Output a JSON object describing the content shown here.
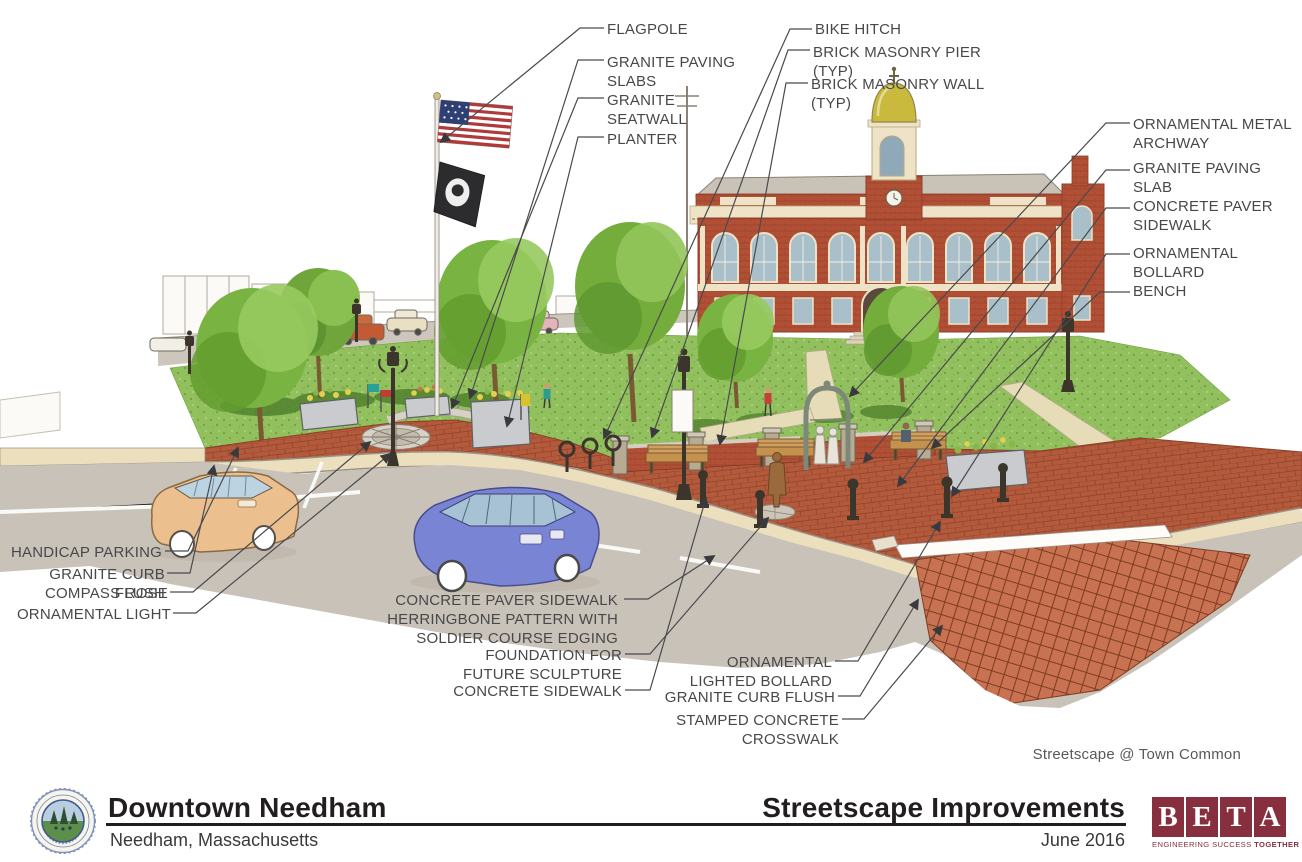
{
  "callouts": {
    "flagpole": "FLAGPOLE",
    "granite_paving_slabs": "GRANITE PAVING\nSLABS",
    "granite_seatwall": "GRANITE\nSEATWALL",
    "planter": "PLANTER",
    "bike_hitch": "BIKE HITCH",
    "brick_masonry_pier": "BRICK MASONRY PIER\n(TYP)",
    "brick_masonry_wall": "BRICK MASONRY WALL\n(TYP)",
    "ornamental_metal_archway": "ORNAMENTAL METAL\nARCHWAY",
    "granite_paving_slab": "GRANITE PAVING SLAB",
    "concrete_paver_sidewalk": "CONCRETE PAVER\nSIDEWALK",
    "ornamental_bollard": "ORNAMENTAL\nBOLLARD",
    "bench": "BENCH",
    "handicap_parking": "HANDICAP PARKING",
    "granite_curb_flush_left": "GRANITE CURB FLUSH",
    "compass_rose": "COMPASS ROSE",
    "ornamental_light": "ORNAMENTAL LIGHT",
    "herringbone_sidewalk": "CONCRETE PAVER SIDEWALK\nHERRINGBONE PATTERN WITH\nSOLDIER COURSE EDGING",
    "foundation_sculpture": "FOUNDATION FOR\nFUTURE SCULPTURE",
    "concrete_sidewalk": "CONCRETE SIDEWALK",
    "ornamental_lighted_bollard": "ORNAMENTAL\nLIGHTED BOLLARD",
    "granite_curb_flush_right": "GRANITE CURB FLUSH",
    "stamped_concrete_crosswalk": "STAMPED CONCRETE\nCROSSWALK"
  },
  "caption": "Streetscape @ Town Common",
  "footer": {
    "project_title": "Downtown Needham",
    "project_subtitle": "Needham, Massachusetts",
    "sheet_title": "Streetscape Improvements",
    "date": "June 2016",
    "beta": {
      "letters": [
        "B",
        "E",
        "T",
        "A"
      ],
      "tagline_regular": "ENGINEERING SUCCESS",
      "tagline_bold": "TOGETHER",
      "brand_color": "#872f3f"
    }
  },
  "colors": {
    "label_text": "#48484b",
    "plaza_brick": "#b45a3c",
    "lawn_green": "#93c05e",
    "building_brick": "#b25036",
    "crosswalk": "#c97252"
  }
}
